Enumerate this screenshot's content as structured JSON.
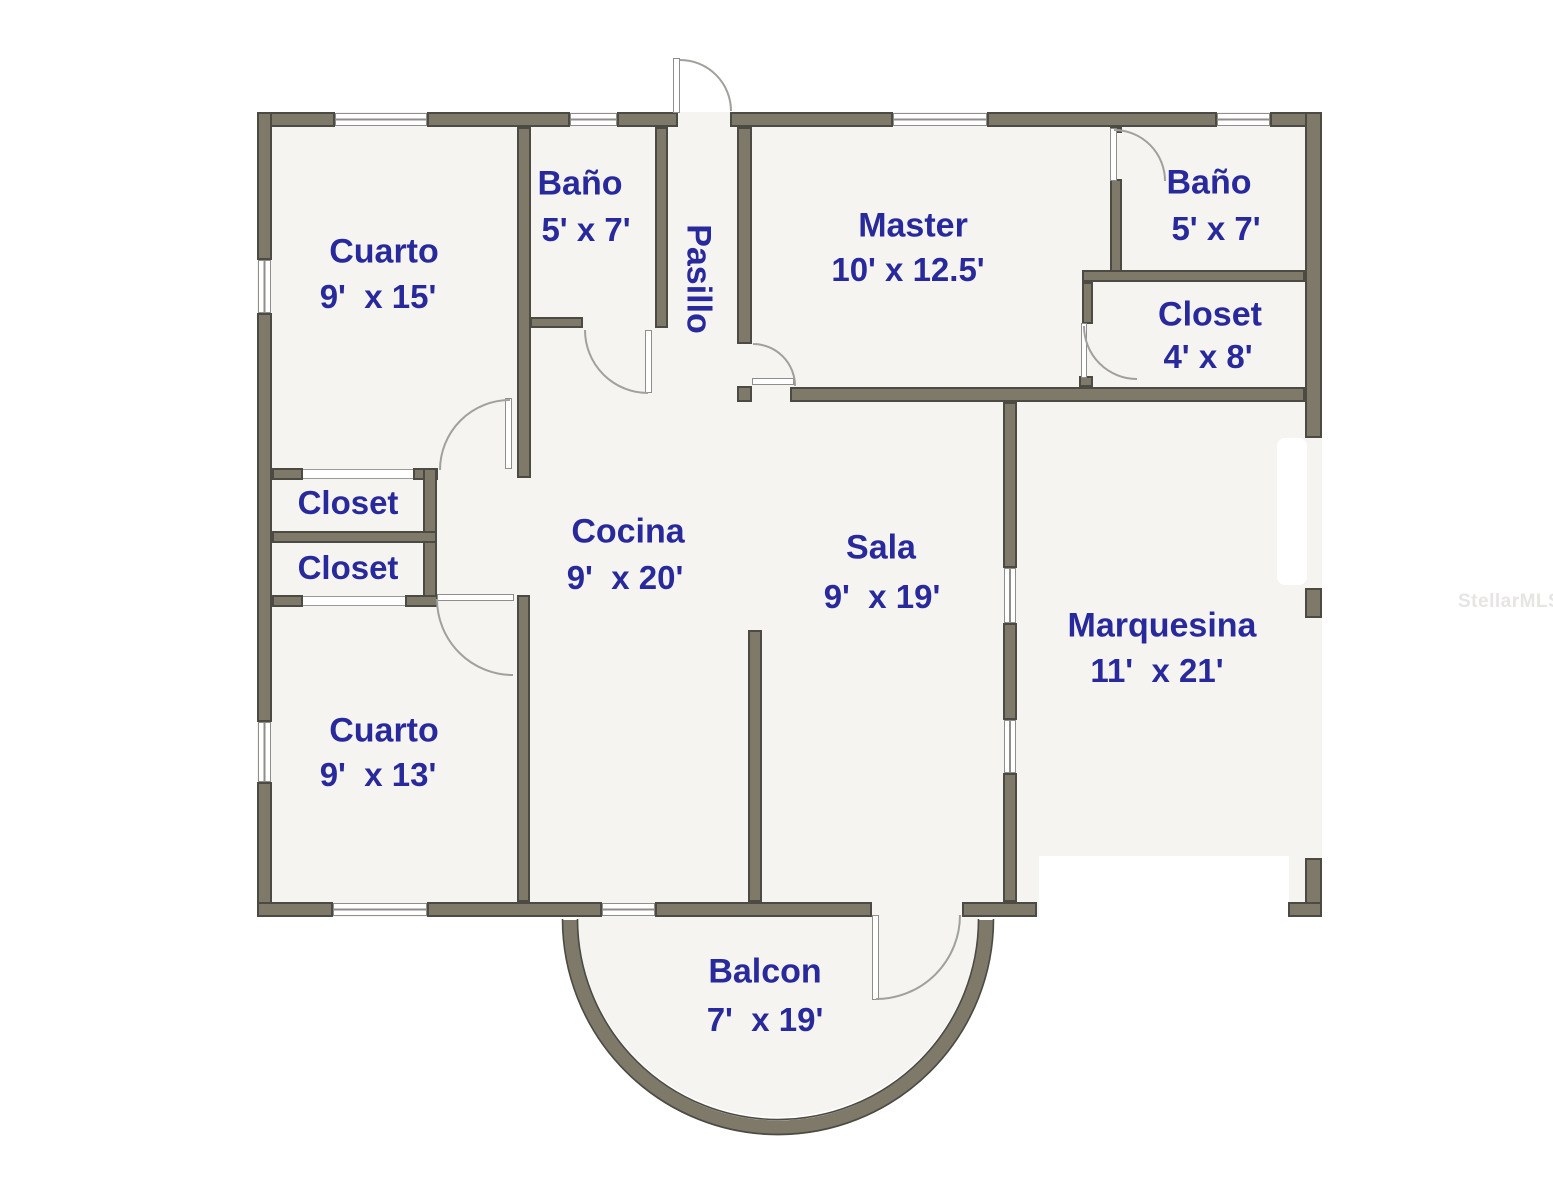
{
  "watermark": "StellarMLS",
  "colors": {
    "wall_fill": "#7e7968",
    "wall_outline": "#4b4a43",
    "label_text": "#282a9c",
    "floor": "#f6f4f0",
    "watermark_text": "#e7e5e1"
  },
  "rooms": {
    "cuarto_top": {
      "name": "Cuarto",
      "dims": "9'  x 15'"
    },
    "bano_top": {
      "name": "Baño",
      "dims": "5' x 7'"
    },
    "pasillo": {
      "name": "Pasillo"
    },
    "master": {
      "name": "Master",
      "dims": "10' x 12.5'"
    },
    "bano_right": {
      "name": "Baño",
      "dims": "5' x 7'"
    },
    "closet_right": {
      "name": "Closet",
      "dims": "4' x 8'"
    },
    "closet_upper": {
      "name": "Closet"
    },
    "closet_lower": {
      "name": "Closet"
    },
    "cocina": {
      "name": "Cocina",
      "dims": "9'  x 20'"
    },
    "sala": {
      "name": "Sala",
      "dims": "9'  x 19'"
    },
    "marquesina": {
      "name": "Marquesina",
      "dims": "11'  x 21'"
    },
    "cuarto_bottom": {
      "name": "Cuarto",
      "dims": "9'  x 13'"
    },
    "balcon": {
      "name": "Balcon",
      "dims": "7'  x 19'"
    }
  }
}
